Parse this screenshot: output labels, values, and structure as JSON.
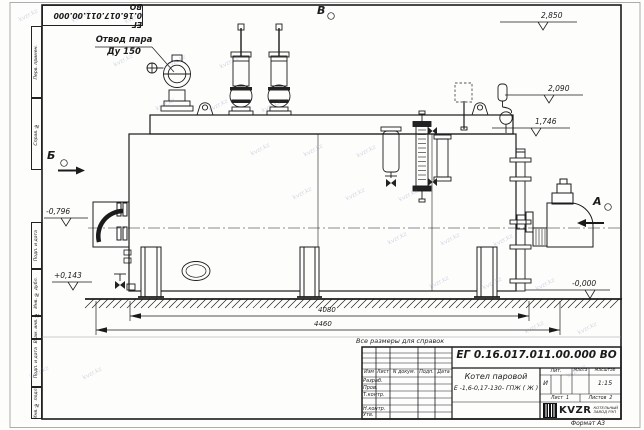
{
  "frame": {
    "doc_number_top": "ЕГ 0.16.017.011.00.000  ВО",
    "format_label": "Формат А3",
    "side_labels": [
      "Перв. примен.",
      "Справ. №",
      "Подп. и дата",
      "Инв. № дубл.",
      "Взам. инв. №",
      "Подп. и дата",
      "Инв. № подл."
    ]
  },
  "annotations": {
    "steam_outlet_line1": "Отвод пара",
    "steam_outlet_line2": "Ду 150",
    "view_a": "А",
    "view_b": "Б",
    "view_v": "В",
    "note": "Все размеры для справок"
  },
  "elevations": {
    "top": "2,850",
    "mid": "2,090",
    "low": "1,746",
    "left_upper": "-0,796",
    "left_lower": "+0,143",
    "ground": "-0,000"
  },
  "dimensions": {
    "inner": "4080",
    "outer": "4460"
  },
  "title_block": {
    "doc_number": "ЕГ 0.16.017.011.00.000  ВО",
    "product_name_line1": "Котел паровой",
    "product_name_line2": "Е -1,6-0,17-130- ГПЖ ( Ж )",
    "header_cols": {
      "izm": "Изм",
      "list": "Лист",
      "doc": "N докум.",
      "sign": "Подп.",
      "date": "Дата"
    },
    "rows": [
      "Разраб.",
      "Пров.",
      "Т.контр.",
      "",
      "Н.контр.",
      "Утв."
    ],
    "lit_header": "Лит.",
    "mass_header": "Масса",
    "scale_header": "Масштаб",
    "lit_value": "И",
    "scale_value": "1:15",
    "sheet_label": "Лист",
    "sheet_value": "1",
    "sheets_label": "Листов",
    "sheets_value": "2",
    "company_logo": "KVZR",
    "company_name_line1": "КОТЕЛЬНЫЙ",
    "company_name_line2": "ЗАВОД РЭП"
  },
  "watermark": {
    "text": "kvzr.kz"
  },
  "colors": {
    "line": "#1b1b1b",
    "paper": "#fdfdfc"
  }
}
